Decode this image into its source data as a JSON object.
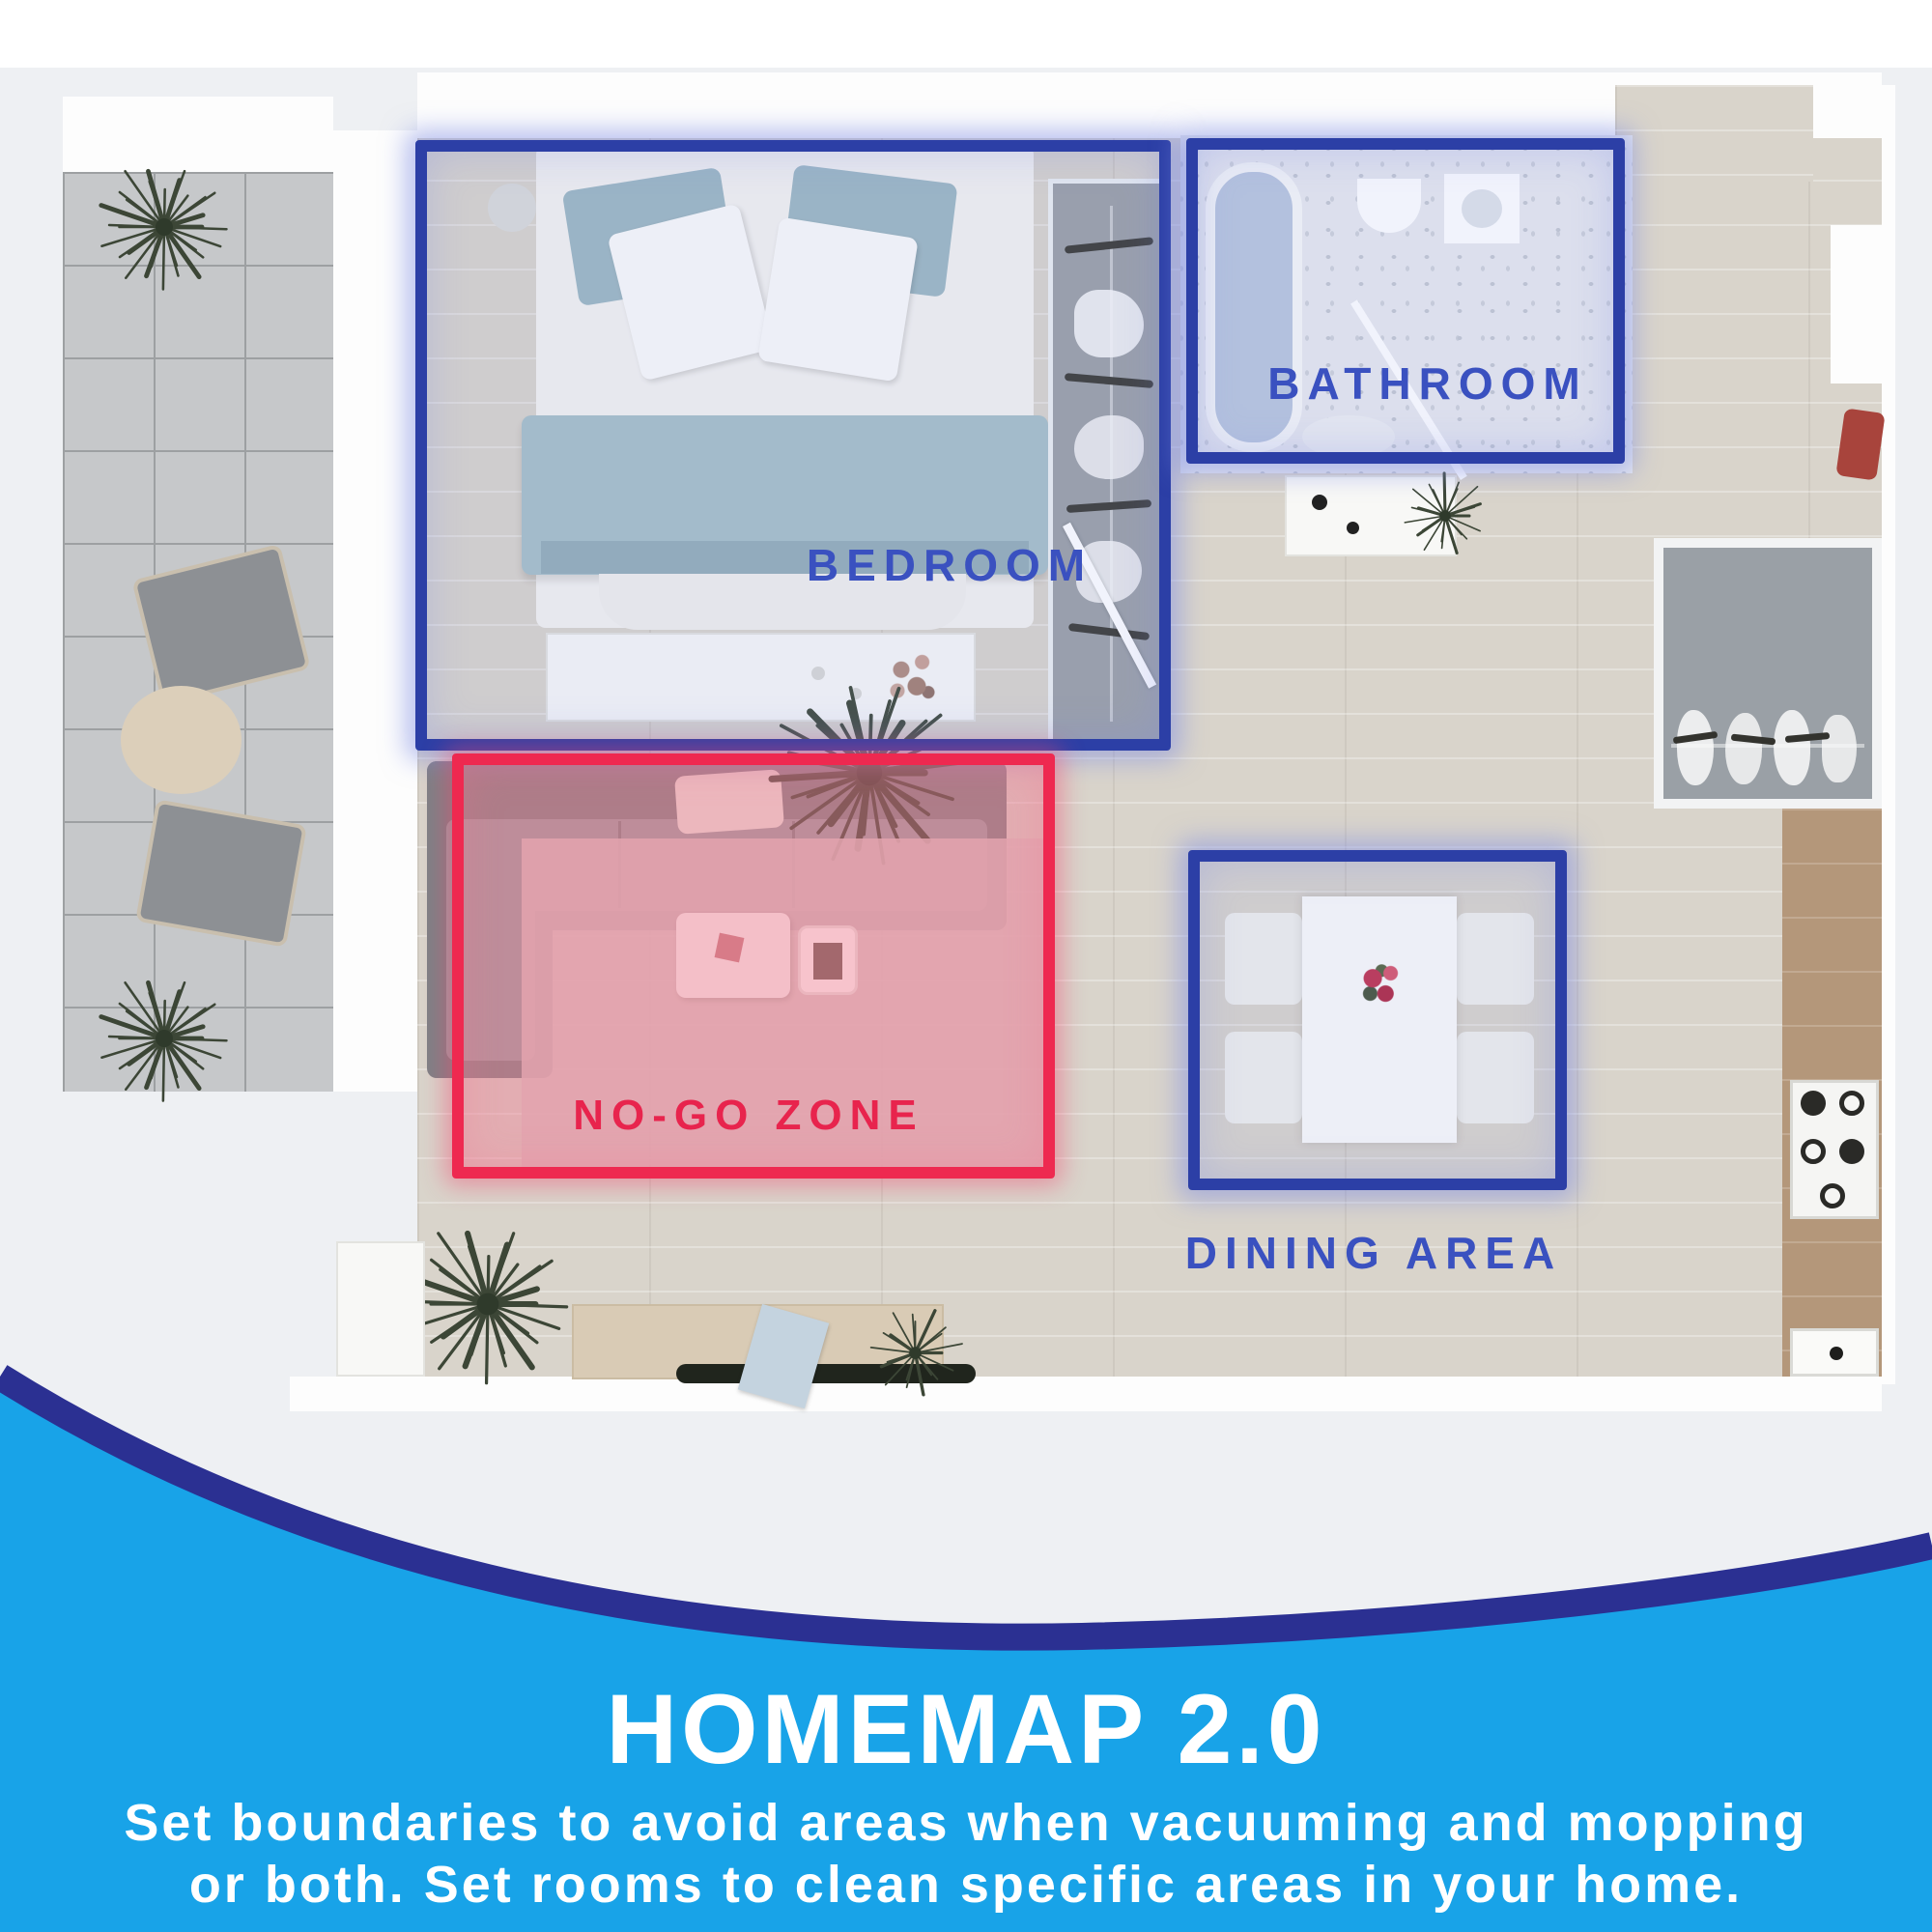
{
  "zones": {
    "bedroom": {
      "label": "BEDROOM"
    },
    "bathroom": {
      "label": "BATHROOM"
    },
    "dining": {
      "label": "DINING AREA"
    },
    "nogo": {
      "label": "NO-GO ZONE"
    }
  },
  "footer": {
    "title": "HOMEMAP 2.0",
    "line1": "Set boundaries to avoid areas when vacuuming and mopping",
    "line2": "or both. Set rooms to clean specific areas in your home."
  },
  "colors": {
    "zone_blue": "#2c3fa6",
    "label_blue": "#3a51c0",
    "zone_red": "#ee2950",
    "nogo_text": "#e8244d",
    "band_blue": "#18a3e8",
    "band_navy": "#2b3092",
    "plan_background": "#eef0f3"
  }
}
